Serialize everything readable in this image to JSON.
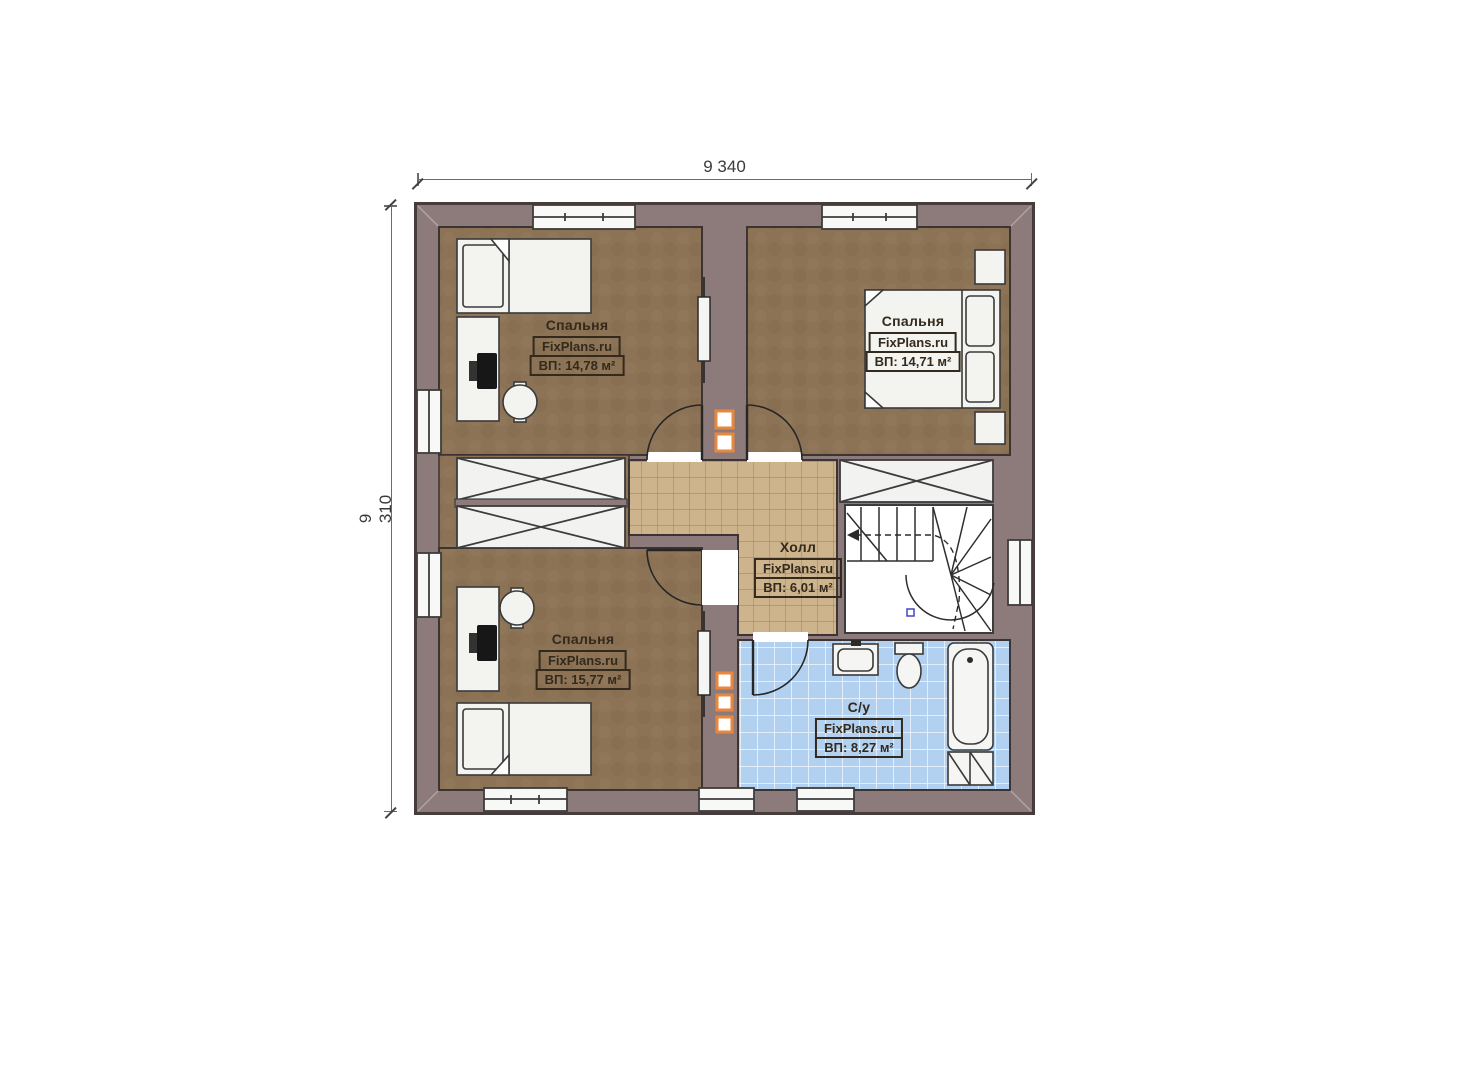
{
  "plan_title": "Second floor plan",
  "brand": "FixPlans.ru",
  "dimensions": {
    "width": "9 340",
    "height": "9 310"
  },
  "rooms": [
    {
      "id": "bedroom-top-left",
      "name": "Спальня",
      "brand": "FixPlans.ru",
      "area": "ВП: 14,78 м²"
    },
    {
      "id": "bedroom-top-right",
      "name": "Спальня",
      "brand": "FixPlans.ru",
      "area": "ВП: 14,71 м²"
    },
    {
      "id": "bedroom-bottom-left",
      "name": "Спальня",
      "brand": "FixPlans.ru",
      "area": "ВП: 15,77 м²"
    },
    {
      "id": "hall",
      "name": "Холл",
      "brand": "FixPlans.ru",
      "area": "ВП: 6,01 м²"
    },
    {
      "id": "bathroom",
      "name": "С/у",
      "brand": "FixPlans.ru",
      "area": "ВП: 8,27 м²"
    }
  ],
  "colors": {
    "wall": "#8d7b7b",
    "wall_outline": "#463c3c",
    "bedroom_floor": "#8c7355",
    "hall_tile": "#cdb48c",
    "bath_tile": "#b2d0ef",
    "furniture": "#f3f3f0",
    "shaft_orange": "#e8873d",
    "label_ink": "#33291c"
  }
}
